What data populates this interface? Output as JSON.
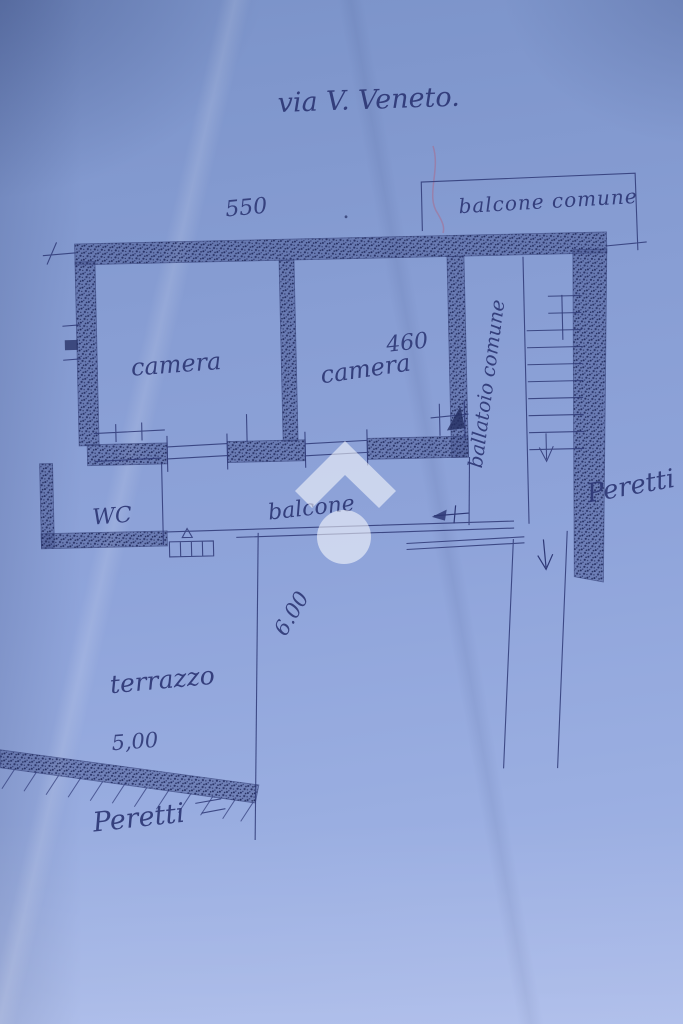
{
  "plan": {
    "street_label": "via V. Veneto.",
    "rooms": {
      "camera_left": "camera",
      "camera_right": "camera",
      "wc": "WC",
      "balcone": "balcone",
      "terrazzo": "terrazzo"
    },
    "common_areas": {
      "balcone_comune": "balcone comune",
      "ballatoio_comune": "ballatoio comune"
    },
    "dimensions": {
      "facade_width": "550",
      "camera_right_width": "460",
      "terrazzo_width": "5,00",
      "terrazzo_depth": "6.00"
    },
    "signatures": {
      "right": "Peretti",
      "bottom": "Peretti"
    },
    "colors": {
      "paper_blue": "#8ba1d6",
      "ink": "#2e3876",
      "watermark_white": "#ffffff"
    },
    "watermark": {
      "icon": "house-logo"
    }
  }
}
